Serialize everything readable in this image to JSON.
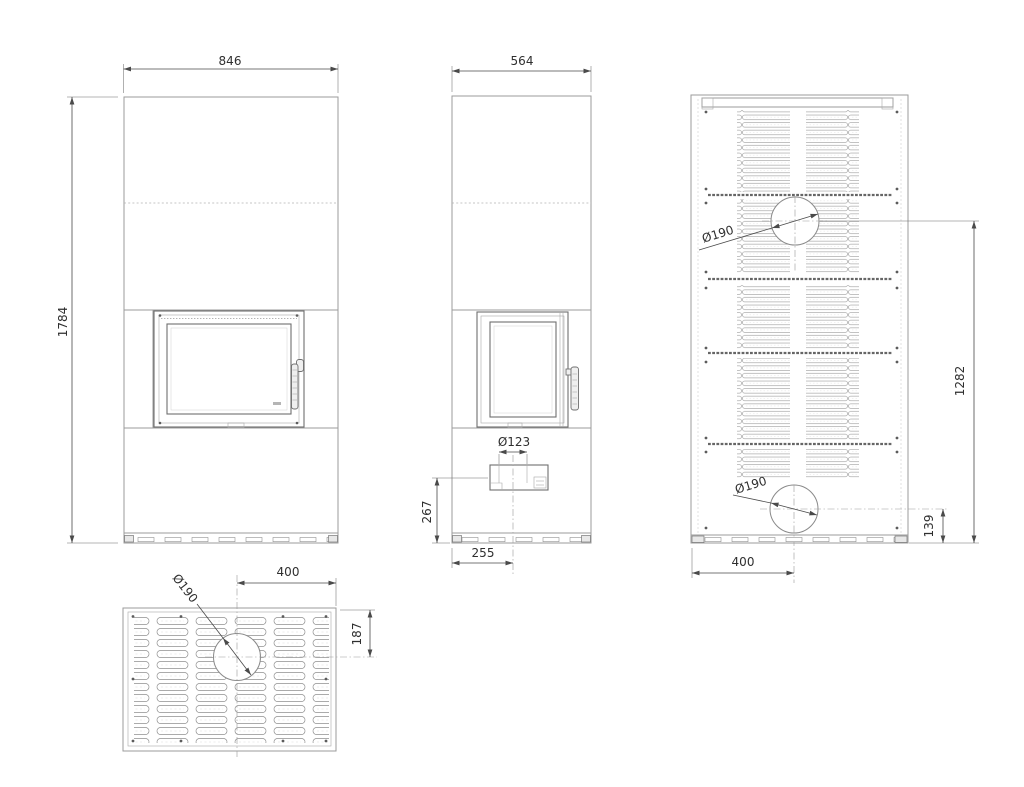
{
  "meta": {
    "drawing_type": "fireplace-stove technical drawing, four orthographic views",
    "background_color": "#ffffff",
    "line_color": "#9b9b9b",
    "dimension_color": "#4a4a4a",
    "text_color": "#2f2f2f"
  },
  "views": {
    "front": {
      "title": "front view",
      "width_mm": "846",
      "height_mm": "1784"
    },
    "side": {
      "title": "side view",
      "width_mm": "564",
      "air_inlet_diameter": "Ø123",
      "air_inlet_center_height": "267",
      "air_inlet_center_offset": "255"
    },
    "back": {
      "title": "back view",
      "upper_flue_diameter": "Ø190",
      "lower_flue_diameter": "Ø190",
      "upper_flue_center_height": "1282",
      "lower_flue_center_height": "139",
      "flue_center_offset": "400"
    },
    "top": {
      "title": "top view",
      "flue_diameter": "Ø190",
      "flue_center_offset_x": "400",
      "flue_center_offset_y": "187"
    }
  }
}
